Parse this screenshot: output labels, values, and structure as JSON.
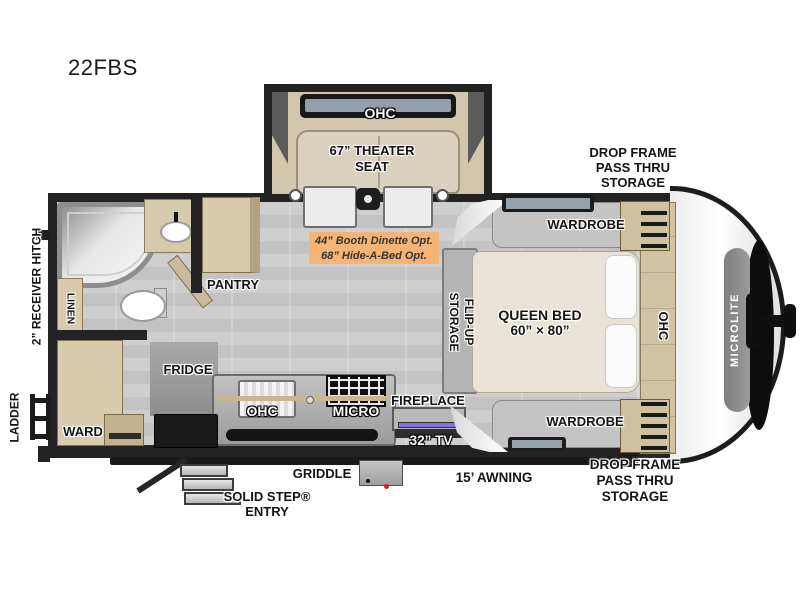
{
  "title": "22FBS",
  "brand": "MICROLITE",
  "slideout": {
    "ohc_label": "OHC",
    "seat_line1": "67” THEATER",
    "seat_line2": "SEAT"
  },
  "storage_top": {
    "line1": "DROP FRAME",
    "line2": "PASS THRU",
    "line3": "STORAGE"
  },
  "storage_bottom": {
    "line1": "DROP FRAME",
    "line2": "PASS THRU",
    "line3": "STORAGE"
  },
  "bedroom": {
    "wardrobe_top": "WARDROBE",
    "wardrobe_bottom": "WARDROBE",
    "bed_line1": "QUEEN BED",
    "bed_line2": "60” × 80”",
    "flipup_line1": "FLIP-UP",
    "flipup_line2": "STORAGE",
    "ohc_vertical": "OHC"
  },
  "bath": {
    "linen": "LINEN"
  },
  "kitchen": {
    "pantry": "PANTRY",
    "fridge": "FRIDGE",
    "ohc": "OHC",
    "micro": "MICRO"
  },
  "living": {
    "fireplace": "FIREPLACE",
    "tv": "32” TV",
    "option_line1": "44” Booth Dinette Opt.",
    "option_line2": "68” Hide-A-Bed Opt."
  },
  "rear": {
    "ward": "WARD",
    "ladder": "LADDER",
    "receiver_hitch": "2” RECEIVER HITCH"
  },
  "exterior": {
    "griddle": "GRIDDLE",
    "step_line1": "SOLID STEP®",
    "step_line2": "ENTRY",
    "awning": "15’ AWNING"
  },
  "colors": {
    "wall": "#232323",
    "cabinet_tan": "#d7c9ab",
    "floor_gray": "#c9c9c9",
    "option_highlight": "#f5b476",
    "tv_strip_purple": "#8276dd",
    "seat_beige": "#d9d0bd",
    "bed_cream": "#e8e3d6"
  }
}
